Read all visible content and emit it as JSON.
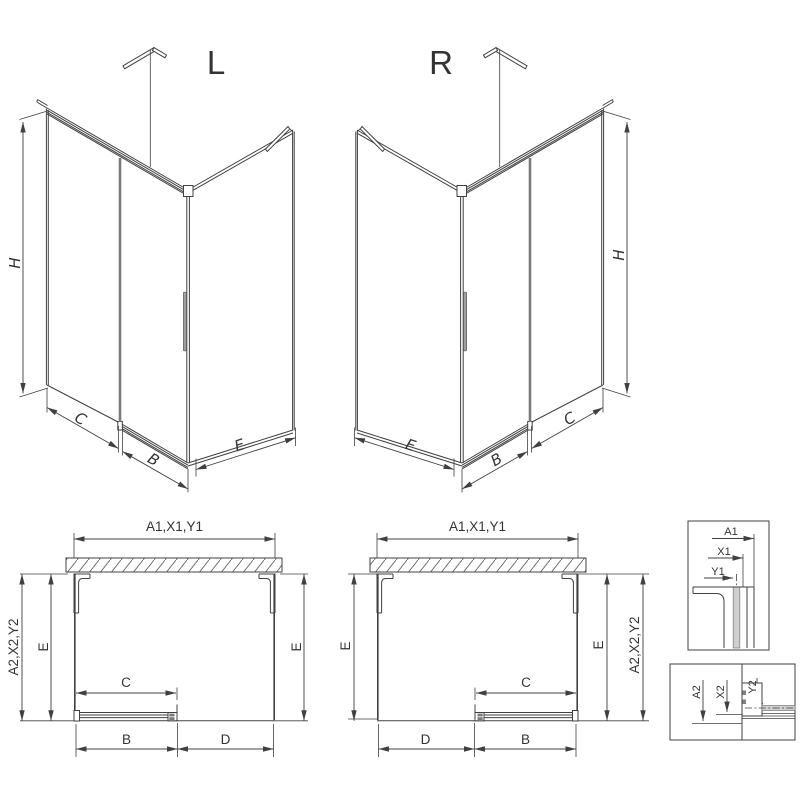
{
  "colors": {
    "line": "#404040",
    "secondary": "#7a7a7a",
    "glass_fill": "#cfcfcf",
    "text": "#333333"
  },
  "iso_left": {
    "title": "L",
    "height_label": "H",
    "fixed_panel_label": "C",
    "door_label": "B",
    "side_panel_label": "E"
  },
  "iso_right": {
    "title": "R",
    "height_label": "H",
    "fixed_panel_label": "C",
    "door_label": "B",
    "side_panel_label": "E"
  },
  "plan_left": {
    "width_label": "A1,X1,Y1",
    "outer_width_label": "A2,X2,Y2",
    "depth_left_label": "E",
    "depth_right_label": "E",
    "door_travel_label": "C",
    "door_width_label": "B",
    "opening_label": "D"
  },
  "plan_right": {
    "width_label": "A1,X1,Y1",
    "outer_width_label": "A2,X2,Y2",
    "depth_left_label": "E",
    "depth_right_label": "E",
    "door_travel_label": "C",
    "door_width_label": "B",
    "opening_label": "D"
  },
  "detail_wall_profile": {
    "labels": [
      "A1",
      "X1",
      "Y1"
    ]
  },
  "detail_bottom_rail": {
    "labels": [
      "A2",
      "X2",
      "Y2"
    ]
  }
}
